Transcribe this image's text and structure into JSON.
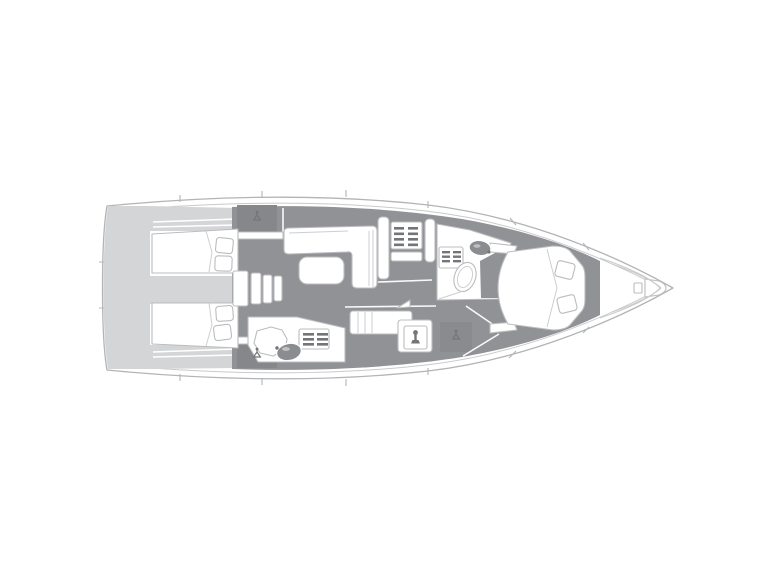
{
  "figure": {
    "kind": "sailing-yacht-interior-floorplan",
    "view": "top-down",
    "bow_direction": "right"
  },
  "colors": {
    "white": "#ffffff",
    "floor_dark": "#909295",
    "cabinet_dark": "#85878a",
    "locker_mid": "#898b8e",
    "deck_light": "#d4d5d7",
    "hull_stroke": "#b3b4b6",
    "hull_stroke_light": "#c9cacc",
    "furniture_stroke": "#bbbcbe",
    "detail_stroke": "#cdced0",
    "fixture_fill": "#8a8c8f",
    "icon_dark": "#737578"
  },
  "regions": [
    {
      "id": "stern-platform",
      "label": "stern platform / cockpit steps"
    },
    {
      "id": "aft-cabin-port",
      "label": "aft double cabin (top)"
    },
    {
      "id": "aft-cabin-starboard",
      "label": "aft double cabin (bottom)"
    },
    {
      "id": "companionway-steps",
      "label": "companionway steps"
    },
    {
      "id": "wardrobe-port",
      "label": "hanging wardrobe (top)"
    },
    {
      "id": "wardrobe-starboard",
      "label": "hanging wardrobe (bottom)"
    },
    {
      "id": "salon-settee",
      "label": "salon L-shaped settee"
    },
    {
      "id": "salon-table",
      "label": "salon table"
    },
    {
      "id": "side-settee",
      "label": "side settee"
    },
    {
      "id": "galley",
      "label": "galley with stove"
    },
    {
      "id": "aft-head",
      "label": "aft head: toilet, shower grate, washbasin"
    },
    {
      "id": "nav-station",
      "label": "chart table"
    },
    {
      "id": "forward-head",
      "label": "forward head: toilet, shower grate, washbasin"
    },
    {
      "id": "forward-cabin",
      "label": "forward V-berth cabin with pillows"
    },
    {
      "id": "anchor-locker",
      "label": "bow anchor locker"
    }
  ],
  "icons": [
    "hanger-icon",
    "stove-burner-grate-icon",
    "shower-grate-icon",
    "washbasin-icon",
    "toilet-icon",
    "faucet-icon",
    "lamp-icon",
    "companionway-steps-icon",
    "anchor-locker-icon",
    "door-swing-icon"
  ]
}
